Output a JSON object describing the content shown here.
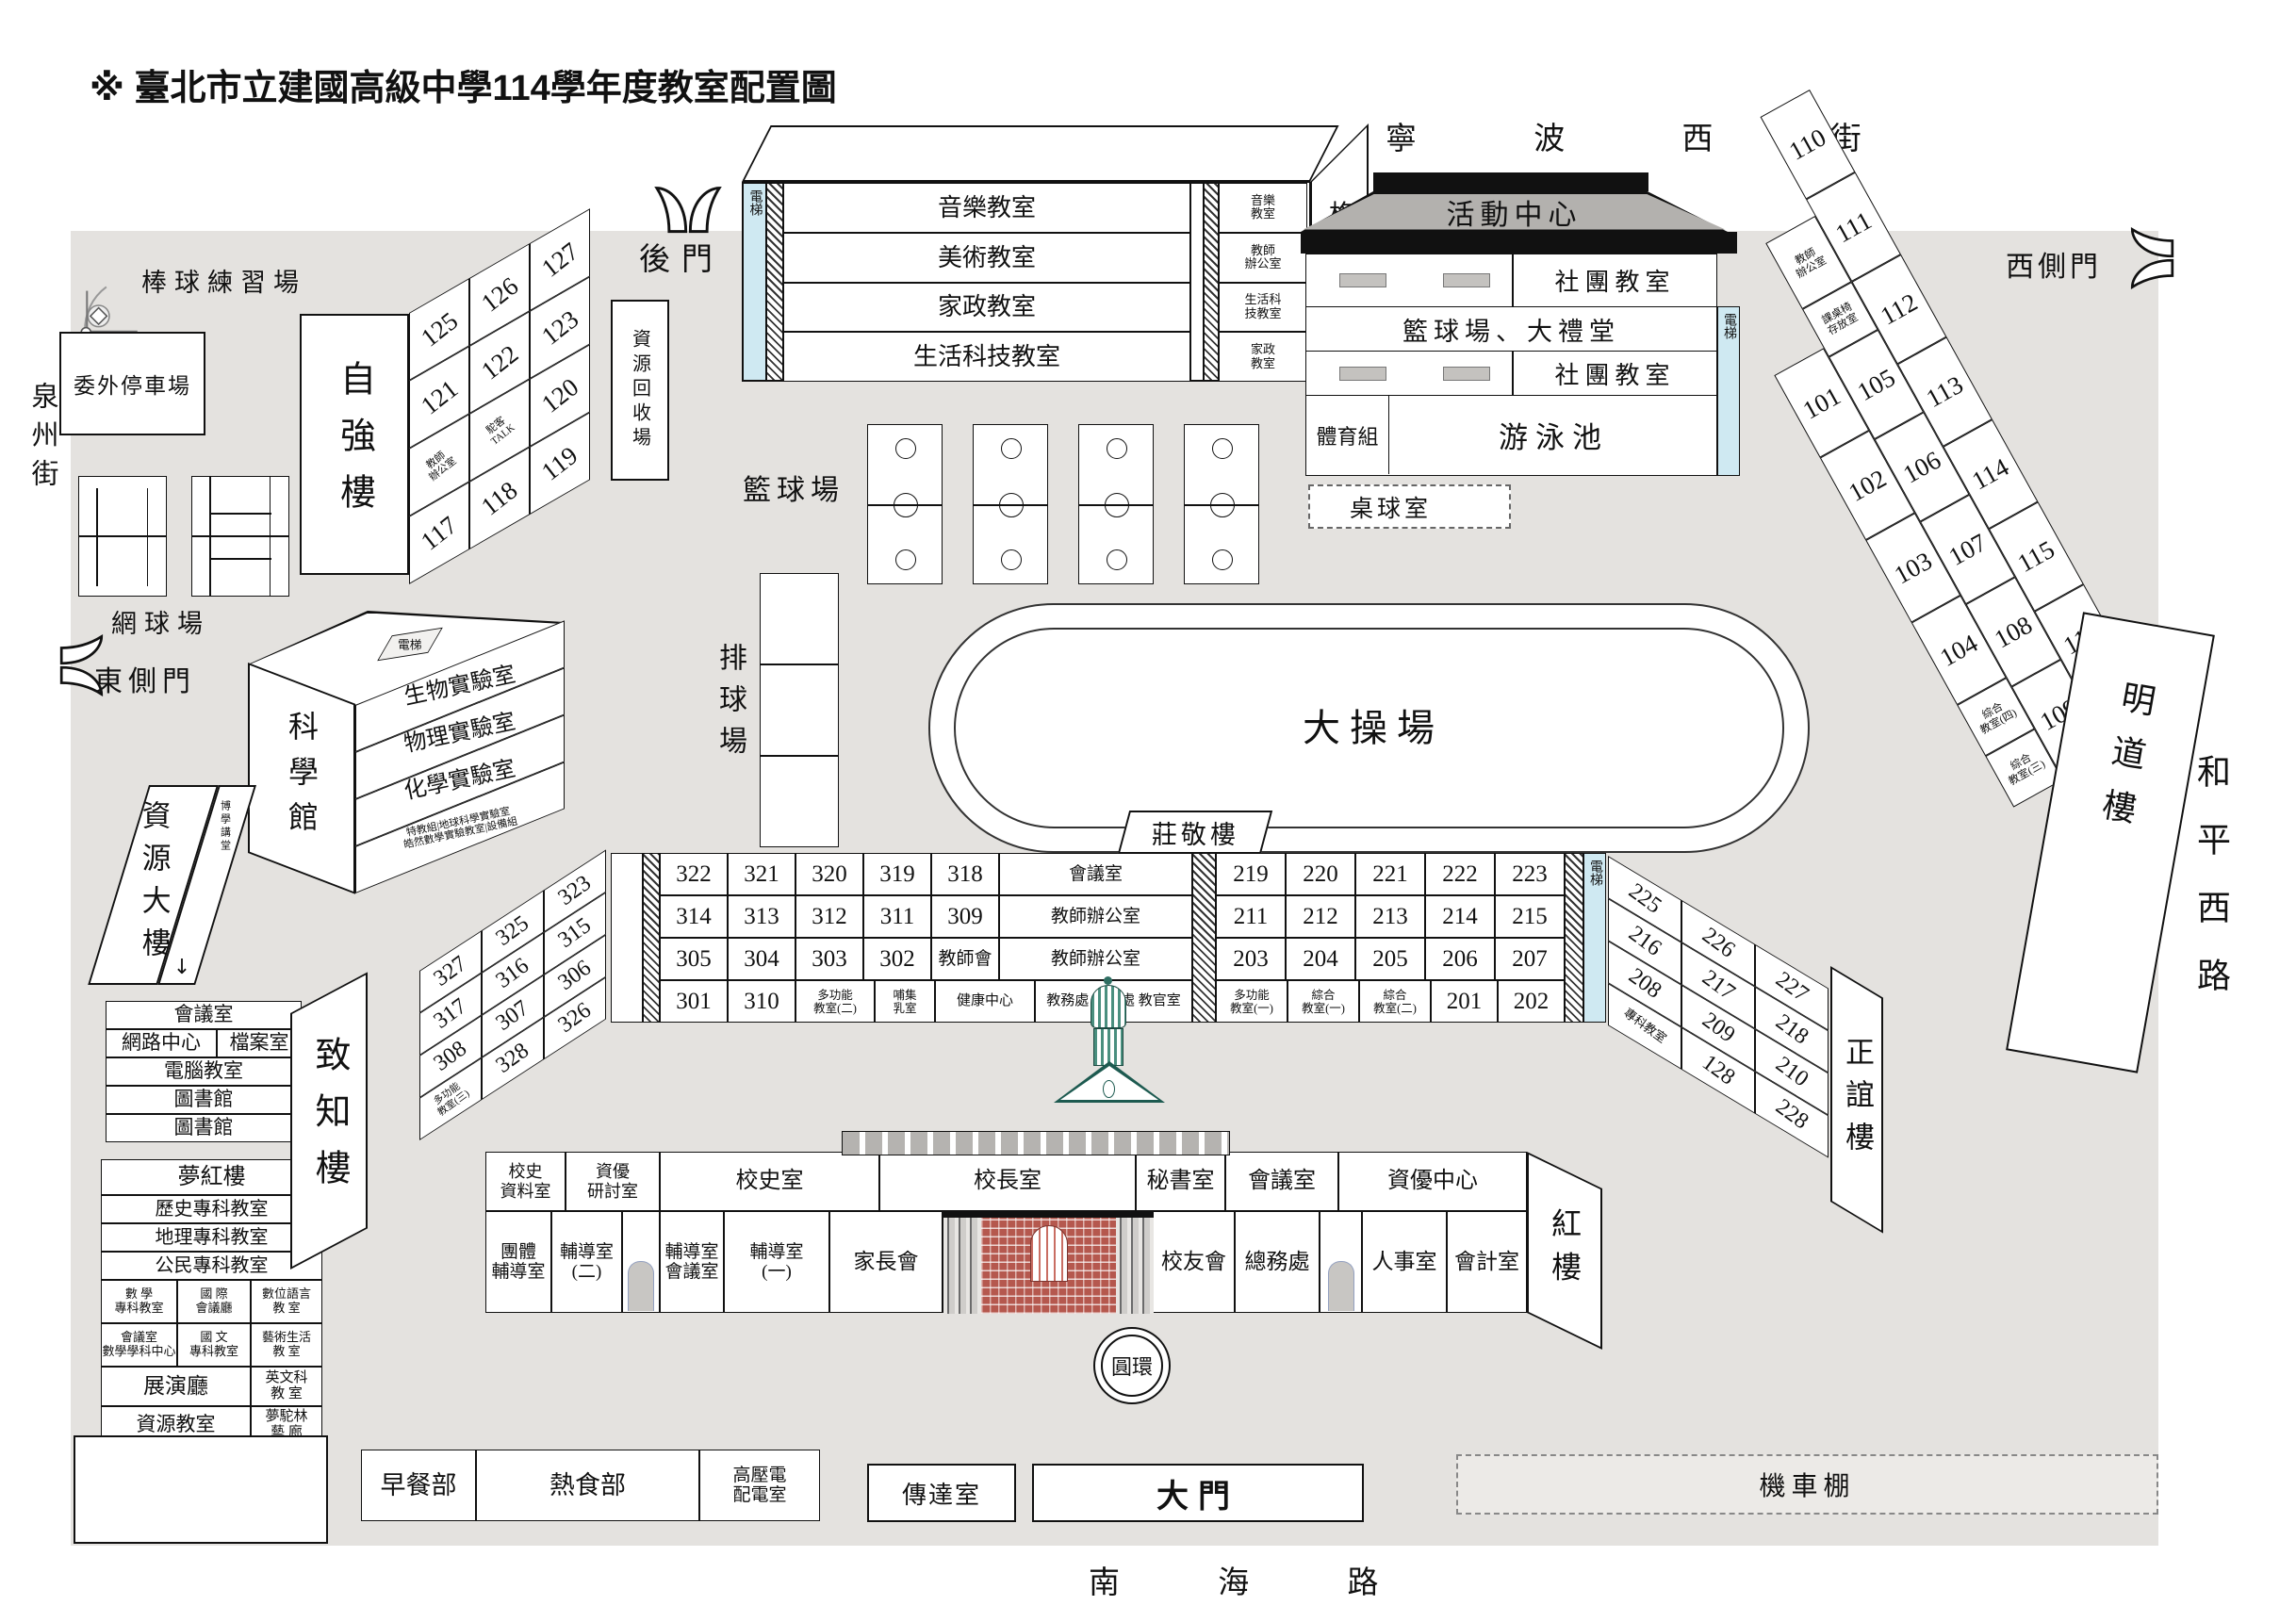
{
  "title": "※ 臺北市立建國高級中學114學年度教室配置圖",
  "streets": {
    "north": "寧 波 西 街",
    "south": "南 海 路",
    "west": "泉州街",
    "east": "和平西路"
  },
  "gates": {
    "back": "後門",
    "east_side": "東側門",
    "west_side": "西側門",
    "main": "大門"
  },
  "grounds": {
    "baseball": "棒球練習場",
    "parking": "委外停車場",
    "tennis": "網球場",
    "basketball": "籃球場",
    "volleyball": "排球場",
    "track": "大操場",
    "table_tennis": "桌球室",
    "recycle": "資源回收場",
    "roundabout": "圓環",
    "bike_shed": "機車棚"
  },
  "icons": {
    "gate": "double-door-icon",
    "baseball_field": "baseball-field-icon",
    "arrow_down": "↓"
  },
  "ziqiang": {
    "name": "自強樓",
    "rooms": [
      [
        "125",
        "126",
        "127"
      ],
      [
        "121",
        "122",
        "123"
      ],
      [
        "教師\n辦公室",
        "駝客\nTALK",
        "120"
      ],
      [
        "117",
        "118",
        "119"
      ]
    ]
  },
  "gewu": {
    "name": "格物樓",
    "elevator": "電梯",
    "main_rooms": [
      [
        "音樂教室"
      ],
      [
        "美術教室"
      ],
      [
        "家政教室"
      ],
      [
        "生活科技教室"
      ]
    ],
    "side_rooms": [
      [
        "音樂\n教室"
      ],
      [
        "教師\n辦公室"
      ],
      [
        "生活科\n技教室"
      ],
      [
        "家政\n教室"
      ]
    ]
  },
  "activity": {
    "name": "活動中心",
    "club_room_1": "社團教室",
    "hall": "籃球場、大禮堂",
    "club_room_2": "社團教室",
    "pe_office": "體育組",
    "pool": "游泳池",
    "elevator": "電梯"
  },
  "mingdao": {
    "name": "明道樓",
    "row1": [
      [
        "110",
        "111",
        "112",
        "113",
        "114",
        "115",
        "116"
      ]
    ],
    "row2": [
      [
        "教師\n辦公室",
        "課桌椅\n存放室",
        "105",
        "106",
        "107",
        "108",
        "109"
      ]
    ],
    "row3": [
      [
        "101",
        "102",
        "103",
        "104",
        "綜合\n教室(四)",
        "綜合\n教室(三)"
      ]
    ]
  },
  "science": {
    "name": "科學館",
    "elevator": "電梯",
    "floors": [
      [
        "生物實驗室"
      ],
      [
        "物理實驗室"
      ],
      [
        "化學實驗室"
      ],
      [
        "特教組|地球科學實驗室\n皓然數學實驗教室|設備組"
      ]
    ]
  },
  "resource": {
    "name": "資源大樓",
    "hall": "博學講堂",
    "stack": [
      [
        "會議室"
      ],
      [
        "網路中心",
        "檔案室"
      ],
      [
        "電腦教室"
      ],
      [
        "圖書館"
      ],
      [
        "圖書館"
      ]
    ]
  },
  "menghong": {
    "row1": [
      [
        "夢紅樓"
      ]
    ],
    "rows": [
      [
        "歷史專科教室"
      ],
      [
        "地理專科教室"
      ],
      [
        "公民專科教室"
      ]
    ],
    "grid": [
      [
        "數 學\n專科教室",
        "國 際\n會議廳",
        "數位語言\n教 室"
      ],
      [
        "會議室\n數學學科中心",
        "國 文\n專科教室",
        "藝術生活\n教 室"
      ]
    ],
    "row7": [
      [
        "展演廳",
        "英文科\n教 室"
      ]
    ],
    "row8": [
      [
        "資源教室",
        "夢駝林\n藝 廊"
      ]
    ]
  },
  "zhuangjing": "莊敬樓",
  "zhizhi": {
    "name": "致知樓",
    "rooms": [
      [
        "327",
        "325",
        "323"
      ],
      [
        "317",
        "316",
        "315"
      ],
      [
        "308",
        "307",
        "306"
      ],
      [
        "多功能\n教室(三)",
        "328",
        "326"
      ]
    ]
  },
  "central_left": {
    "upper": [
      [
        "322",
        "321",
        "320",
        "319",
        "318",
        "會議室"
      ],
      [
        "314",
        "313",
        "312",
        "311",
        "309",
        "教師辦公室"
      ],
      [
        "305",
        "304",
        "303",
        "302",
        "教師會",
        "教師辦公室"
      ]
    ],
    "row4": [
      [
        "301",
        "310",
        "多功能\n教室(二)",
        "哺集\n乳室",
        "健康中心",
        "教務處 學務處 教官室"
      ]
    ]
  },
  "central_right": {
    "upper": [
      [
        "219",
        "220",
        "221",
        "222",
        "223"
      ],
      [
        "211",
        "212",
        "213",
        "214",
        "215"
      ],
      [
        "203",
        "204",
        "205",
        "206",
        "207"
      ]
    ],
    "row4": [
      [
        "多功能\n教室(一)",
        "綜合\n教室(一)",
        "綜合\n教室(二)",
        "201",
        "202"
      ]
    ],
    "elevator": "電梯"
  },
  "zhengyi": {
    "name": "正誼樓",
    "rooms": [
      [
        "225",
        "226",
        "227"
      ],
      [
        "216",
        "217",
        "218"
      ],
      [
        "208",
        "209",
        "210"
      ],
      [
        "專科教室",
        "128",
        "228"
      ]
    ]
  },
  "honglou": {
    "name": "紅樓",
    "top_row": [
      [
        "校史\n資料室",
        "資優\n研討室",
        "校史室",
        "校長室",
        "秘書室",
        "會議室",
        "資優中心"
      ]
    ],
    "bottom_left": [
      [
        "團體\n輔導室",
        "輔導室\n(二)"
      ]
    ],
    "bottom_mid": [
      [
        "輔導室\n會議室",
        "輔導室\n(一)",
        "家長會"
      ]
    ],
    "bottom_right": [
      [
        "校友會",
        "總務處"
      ]
    ],
    "bottom_far": [
      [
        "人事室",
        "會計室"
      ]
    ]
  },
  "services": [
    [
      "早餐部",
      "熱食部",
      "高壓電\n配電室"
    ]
  ],
  "reception": "傳達室"
}
